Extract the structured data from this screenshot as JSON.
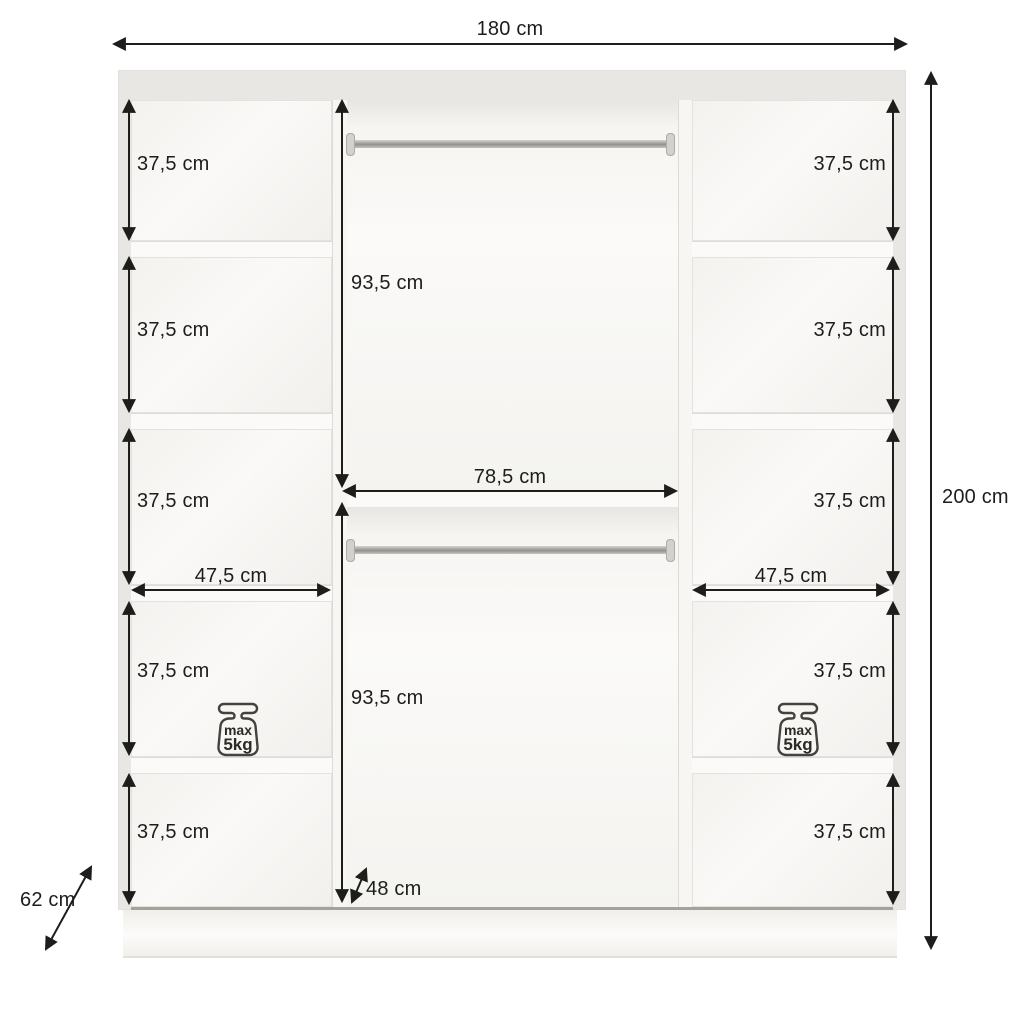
{
  "dimensions": {
    "width": "180 cm",
    "height": "200 cm",
    "depth": "62 cm"
  },
  "left_column": {
    "compartment_heights": [
      "37,5 cm",
      "37,5 cm",
      "37,5 cm",
      "37,5 cm",
      "37,5 cm"
    ],
    "width": "47,5 cm",
    "max_load": {
      "line1": "max",
      "line2": "5kg"
    }
  },
  "middle_column": {
    "top_section_height": "93,5 cm",
    "bottom_section_height": "93,5 cm",
    "width": "78,5 cm",
    "bottom_width": "48 cm"
  },
  "right_column": {
    "compartment_heights": [
      "37,5 cm",
      "37,5 cm",
      "37,5 cm",
      "37,5 cm",
      "37,5 cm"
    ],
    "width": "47,5 cm",
    "max_load": {
      "line1": "max",
      "line2": "5kg"
    }
  }
}
